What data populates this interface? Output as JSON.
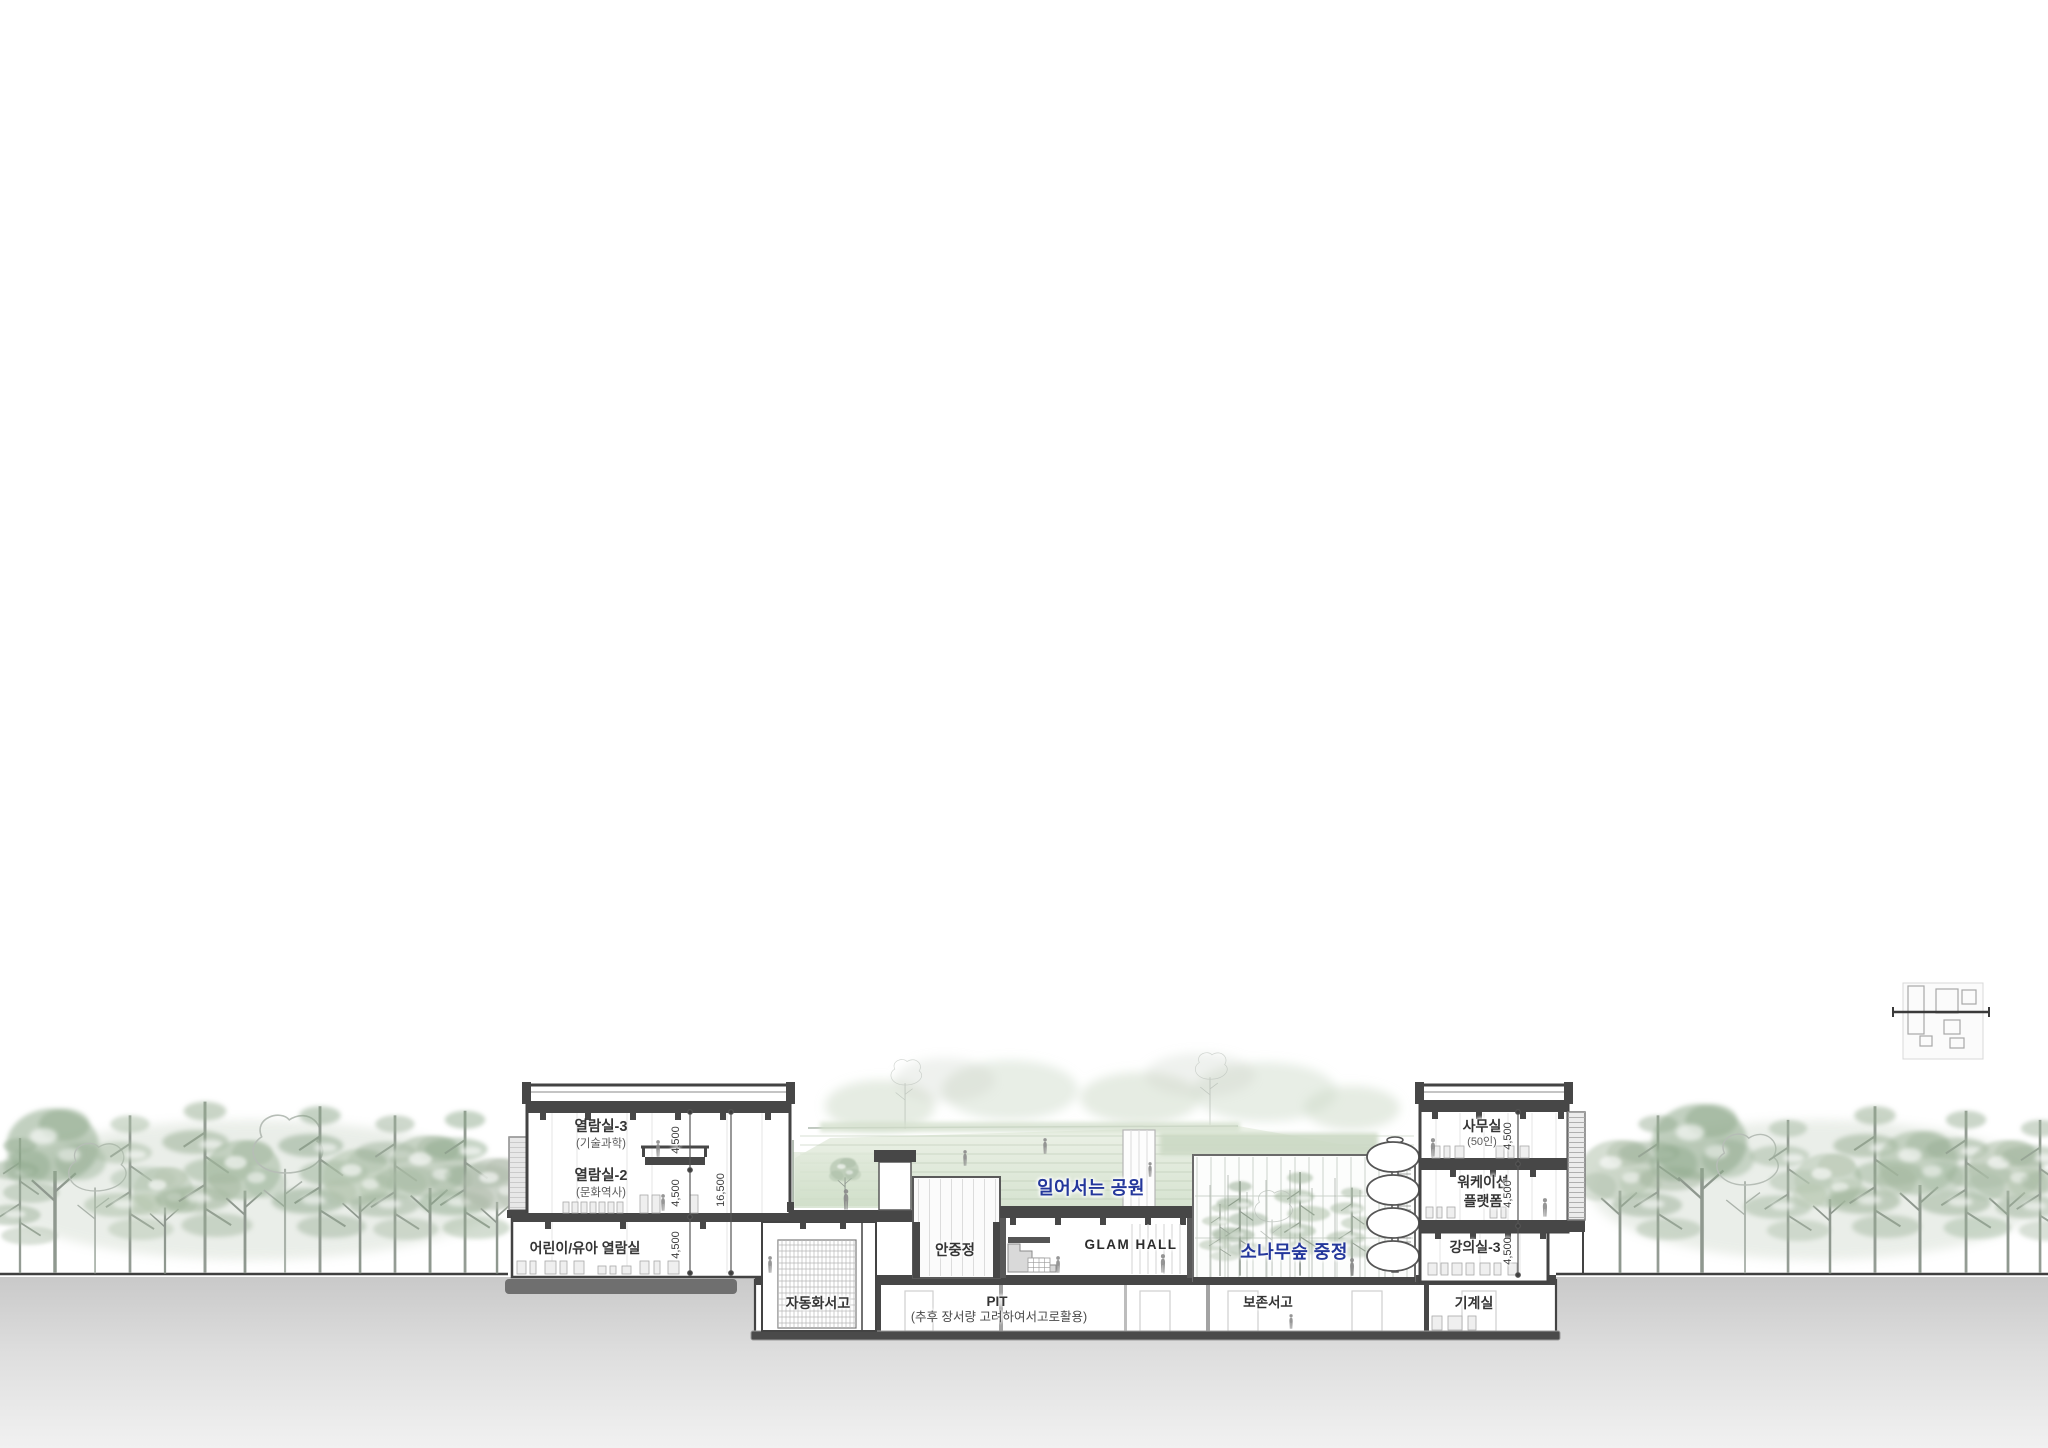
{
  "drawing": {
    "type": "architectural-building-section",
    "accent_blue": "#24379b",
    "line_dark": "#434343",
    "tree_green": "#9ab396",
    "earth_gray": "#c9c9c9"
  },
  "rooms": {
    "reading3": "열람실-3",
    "reading3_sub": "(기술과학)",
    "reading2": "열람실-2",
    "reading2_sub": "(문화역사)",
    "kids": "어린이/유아 열람실",
    "courtyard": "안중정",
    "glam": "GLAM HALL",
    "park_blue": "일어서는 공원",
    "pine_blue": "소나무숲 중정",
    "auto_stack": "자동화서고",
    "pit": "PIT",
    "pit_sub": "(추후 장서량 고려하여서고로활용)",
    "preserve": "보존서고",
    "mech": "기계실",
    "office": "사무실",
    "office_sub": "(50인)",
    "workation_line1": "워케이션",
    "workation_line2": "플랫폼",
    "lecture": "강의실-3"
  },
  "dims": {
    "left": [
      "4,500",
      "4,500",
      "4,500"
    ],
    "left_total": "16,500",
    "right": [
      "4,500",
      "4,500",
      "4,500"
    ]
  }
}
